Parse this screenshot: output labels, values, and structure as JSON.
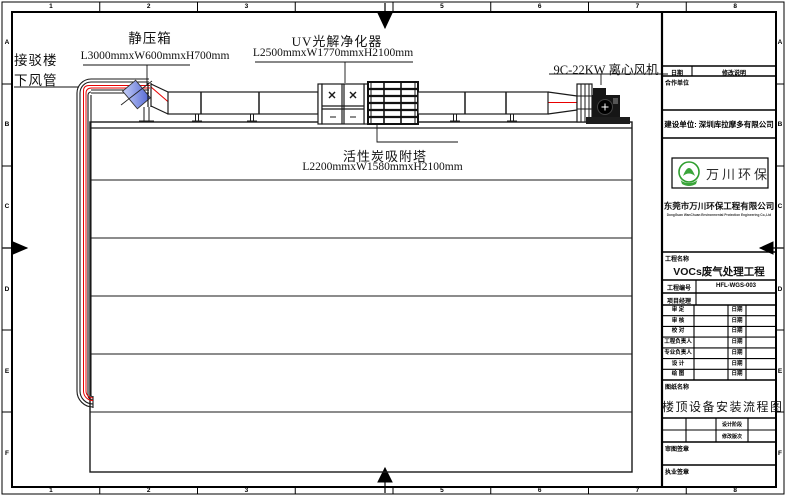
{
  "frame": {
    "top_zones": [
      "1",
      "2",
      "3",
      "",
      "5",
      "6",
      "7",
      "8"
    ],
    "bottom_zones": [
      "1",
      "2",
      "3",
      "",
      "5",
      "6",
      "7",
      "8"
    ],
    "left_zones": [
      "A",
      "B",
      "C",
      "D",
      "E",
      "F"
    ],
    "right_zones": [
      "A",
      "B",
      "C",
      "D",
      "E",
      "F"
    ]
  },
  "drawing": {
    "connection_line1": "接驳楼",
    "connection_line2": "下风管",
    "static_box_name": "静压箱",
    "static_box_dims": "L3000mmxW600mmxH700mm",
    "uv_name": "UV光解净化器",
    "uv_dims": "L2500mmxW1770mmxH2100mm",
    "carbon_name": "活性炭吸附塔",
    "carbon_dims": "L2200mmxW1580mmxH2100mm",
    "fan_name": "9C-22KW 离心风机",
    "colors": {
      "centerline": "#e80000",
      "valve_fill_light": "#c6d0f8",
      "valve_fill_dark": "#4f63d2",
      "linework": "#1a1a1a",
      "logo_green": "#3aa53a"
    }
  },
  "titleblock": {
    "revision_date_label": "日期",
    "revision_desc_label": "修改说明",
    "partner_label": "合作单位",
    "owner_line": "建设单位: 深圳库拉摩多有限公司",
    "logo_text": "万川环保",
    "company_cn": "东莞市万川环保工程有限公司",
    "company_en": "DongGuan WanChuan Environmental Protection Engineering Co.,Ltd",
    "project_name_label": "工程名称",
    "project_name": "VOCs废气处理工程",
    "project_no_label": "工程编号",
    "project_no": "HFL-WGS-003",
    "pm_label": "项目经理",
    "pm_value": "",
    "sign_rows": [
      {
        "label": "审 定",
        "date_label": "日期"
      },
      {
        "label": "审 核",
        "date_label": "日期"
      },
      {
        "label": "校 对",
        "date_label": "日期"
      },
      {
        "label": "工程负责人",
        "date_label": "日期"
      },
      {
        "label": "专业负责人",
        "date_label": "日期"
      },
      {
        "label": "设 计",
        "date_label": "日期"
      },
      {
        "label": "绘 图",
        "date_label": "日期"
      }
    ],
    "drawing_name_label": "图纸名称",
    "drawing_name": "楼顶设备安装流程图",
    "stage_label": "设计阶段",
    "revision_no_label": "修改版次",
    "seal1_label": "审图签章",
    "seal2_label": "执业签章"
  }
}
